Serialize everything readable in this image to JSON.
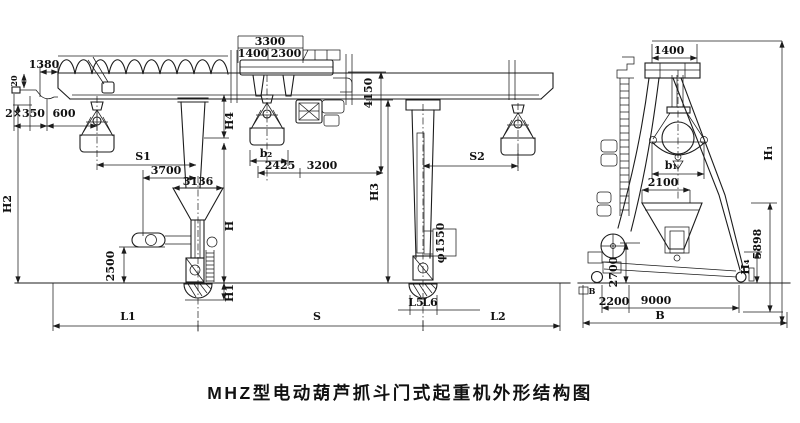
{
  "title": "MHZ型电动葫芦抓斗门式起重机外形结构图",
  "colors": {
    "line": "#1c1c1c",
    "text": "#111111",
    "background": "#ffffff"
  },
  "front_view": {
    "fv": {
      "d1380": "1380",
      "d20": "20",
      "d2x350": "2×350",
      "d600": "600",
      "dH2": "H2",
      "d2500": "2500",
      "s1": "S1",
      "d3700": "3700",
      "d3136": "3136",
      "t3300": "3300",
      "t1400": "1400",
      "t2300": "2300",
      "h4": "H4",
      "h": "H",
      "h1": "H1",
      "b2": "b₂",
      "d2425": "2425",
      "d3200": "3200",
      "d4150": "4150",
      "h3": "H3",
      "s2": "S2",
      "phi": "φ1550",
      "l5": "L5",
      "l6": "L6",
      "l1": "L1",
      "s": "S",
      "l2": "L2"
    }
  },
  "side_view": {
    "sv": {
      "d1400": "1400",
      "b1": "b₁",
      "d2100": "2100",
      "h1": "H₁",
      "d5898": "5898",
      "h4": "H₄",
      "d2700": "2700",
      "bLeft": "B",
      "d2200": "2200",
      "d9000": "9000",
      "bBase": "B"
    }
  }
}
